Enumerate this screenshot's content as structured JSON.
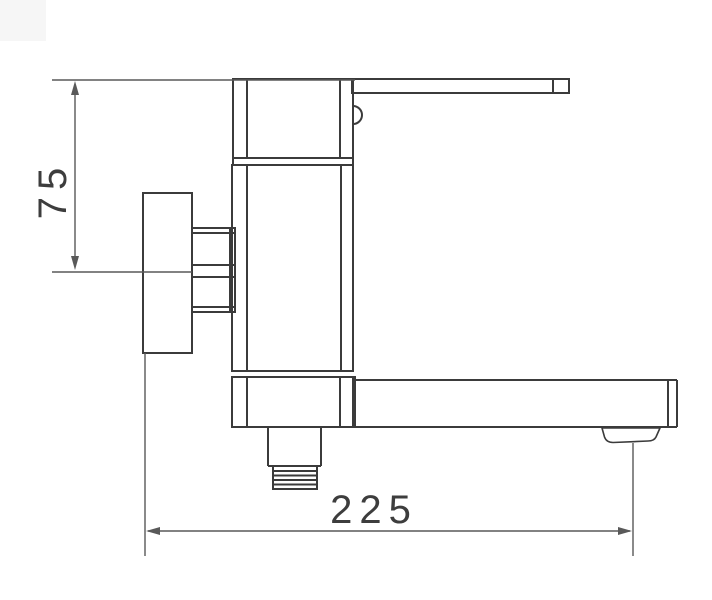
{
  "canvas": {
    "background": "#ffffff",
    "corner_artifact_color": "#f6f6f6"
  },
  "drawing": {
    "line_color": "#3b3b3b",
    "dimension_color": "#595959",
    "text_color": "#3d3d3d",
    "dimensions": {
      "height": {
        "label": "75",
        "orientation": "vertical"
      },
      "reach": {
        "label": "225",
        "orientation": "horizontal"
      }
    }
  }
}
